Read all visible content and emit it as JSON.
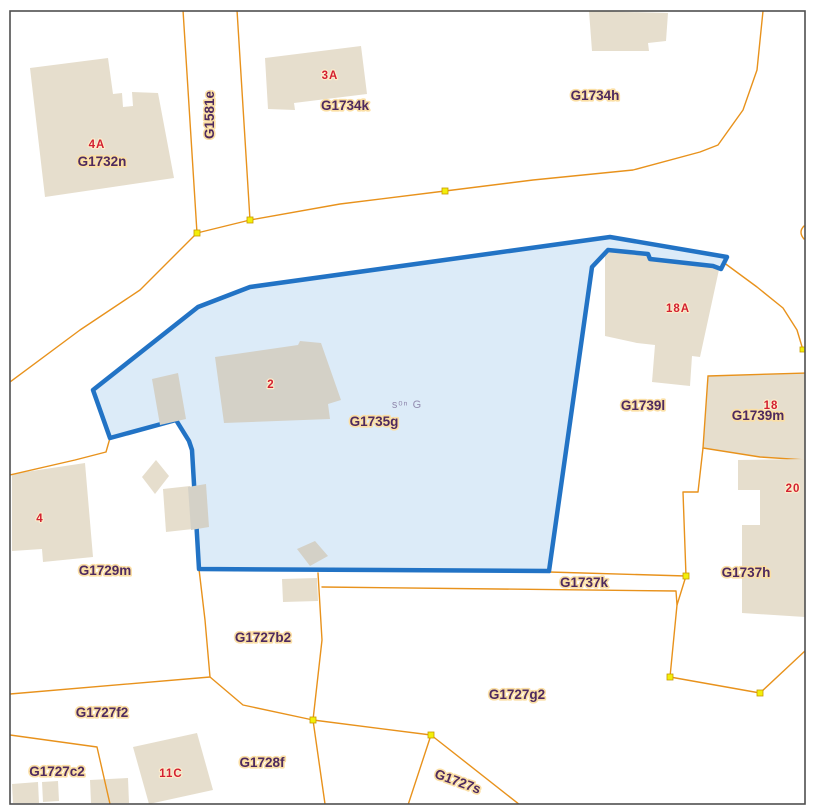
{
  "map": {
    "type": "cadastral-parcel-map",
    "selected_parcel": {
      "id": "G1735g",
      "house_number": "2"
    },
    "colors": {
      "selection_stroke": "#2273c5",
      "selection_fill": "#dcebf8",
      "boundary_orange": "#e8921c",
      "vertex_yellow": "#f2ef09",
      "building_beige": "#e6decd",
      "building_gray": "#d4d1c7",
      "label_plum": "#4e2a5e",
      "label_halo": "#fbdfa5",
      "house_number_red": "#d32031",
      "frame_gray": "#4f4f4f"
    },
    "labels": {
      "g1732n": "G1732n",
      "g1581e": "G1581e",
      "g1734k": "G1734k",
      "g1734h": "G1734h",
      "g1735g": "G1735g",
      "g1739l": "G1739l",
      "g1739m": "G1739m",
      "g1737h": "G1737h",
      "g1737k": "G1737k",
      "g1729m": "G1729m",
      "g1727b2": "G1727b2",
      "g1727g2": "G1727g2",
      "g1727f2": "G1727f2",
      "g1727c2": "G1727c2",
      "g1728f": "G1728f",
      "g1727s": "G1727s"
    },
    "house_numbers": {
      "n4a": "4A",
      "n3a": "3A",
      "n2": "2",
      "n4": "4",
      "n18a": "18A",
      "n18": "18",
      "n20": "20",
      "n11c": "11C"
    },
    "watermark": "sᵒⁿ G"
  }
}
